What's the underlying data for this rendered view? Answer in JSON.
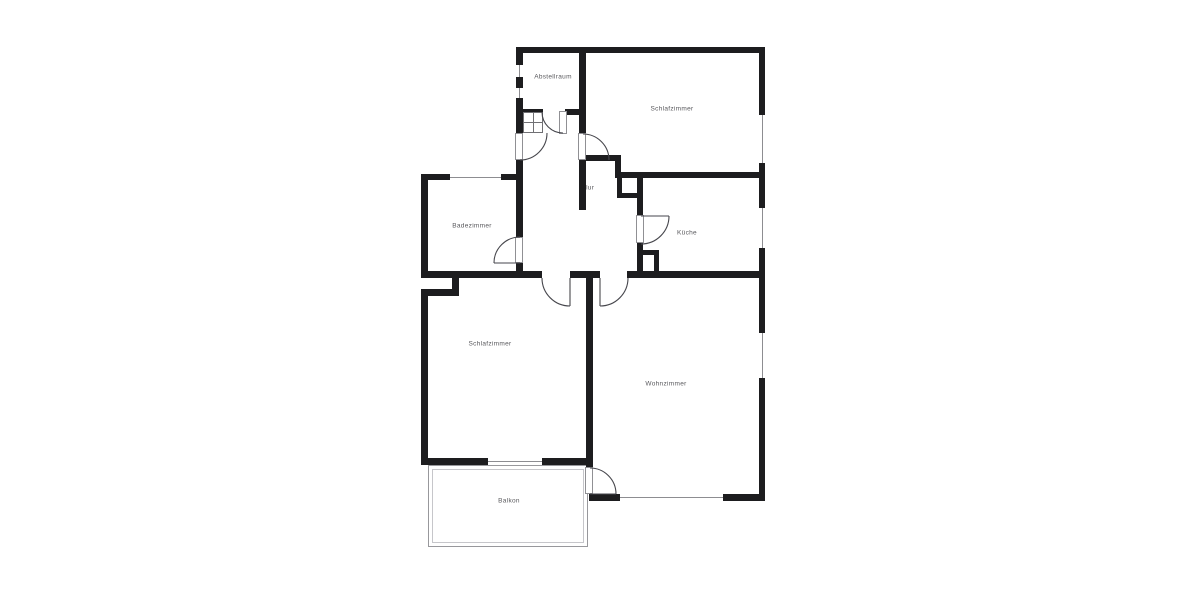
{
  "floor_plan": {
    "rooms": [
      {
        "name": "Abstellraum"
      },
      {
        "name": "Schlafzimmer"
      },
      {
        "name": "Badezimmer"
      },
      {
        "name": "Flur"
      },
      {
        "name": "Küche"
      },
      {
        "name": "Schlafzimmer"
      },
      {
        "name": "Wohnzimmer"
      },
      {
        "name": "Balkon"
      }
    ],
    "colors": {
      "wall": "#1d1d1f",
      "window_line": "#8d8d91",
      "door_line": "#46464c",
      "label": "#58585c",
      "background": "#ffffff"
    }
  }
}
